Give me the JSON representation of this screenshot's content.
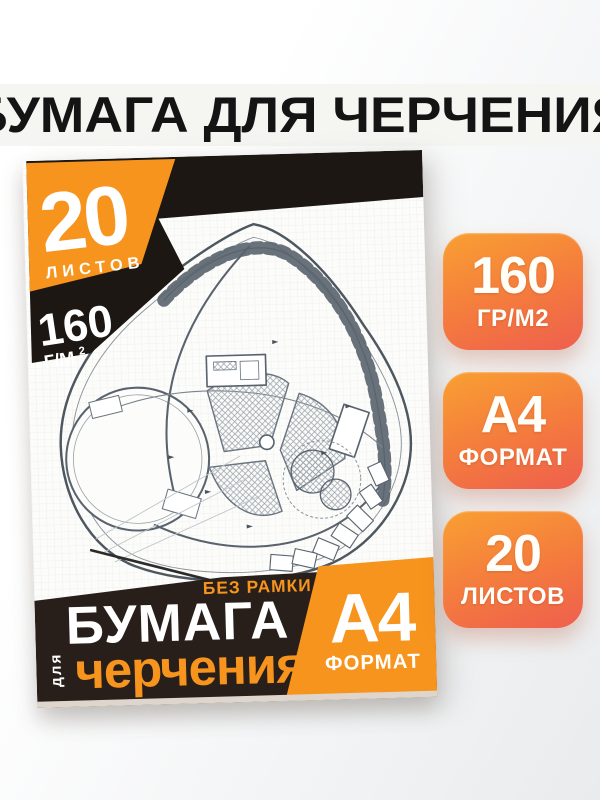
{
  "page": {
    "title": "БУМАГА ДЛЯ ЧЕРЧЕНИЯ"
  },
  "cover": {
    "sheets_count": "20",
    "sheets_word": "ЛИСТОВ",
    "density_value": "160",
    "density_unit": "Г/М",
    "density_sup": "2",
    "no_frame_badge": "БЕЗ РАМКИ",
    "title_word": "БУМАГА",
    "for_word": "для",
    "drafting_word": "черчения",
    "format_value": "А4",
    "format_word": "ФОРМАТ"
  },
  "badges": [
    {
      "value": "160",
      "label": "ГР/М2"
    },
    {
      "value": "А4",
      "label": "ФОРМАТ"
    },
    {
      "value": "20",
      "label": "ЛИСТОВ"
    }
  ],
  "colors": {
    "accent_orange": "#f7941e",
    "cover_black": "#1c1713",
    "band_brown": "#281f1a",
    "badge_gradient_start": "#f9a032",
    "badge_gradient_end": "#ee5f4e"
  }
}
